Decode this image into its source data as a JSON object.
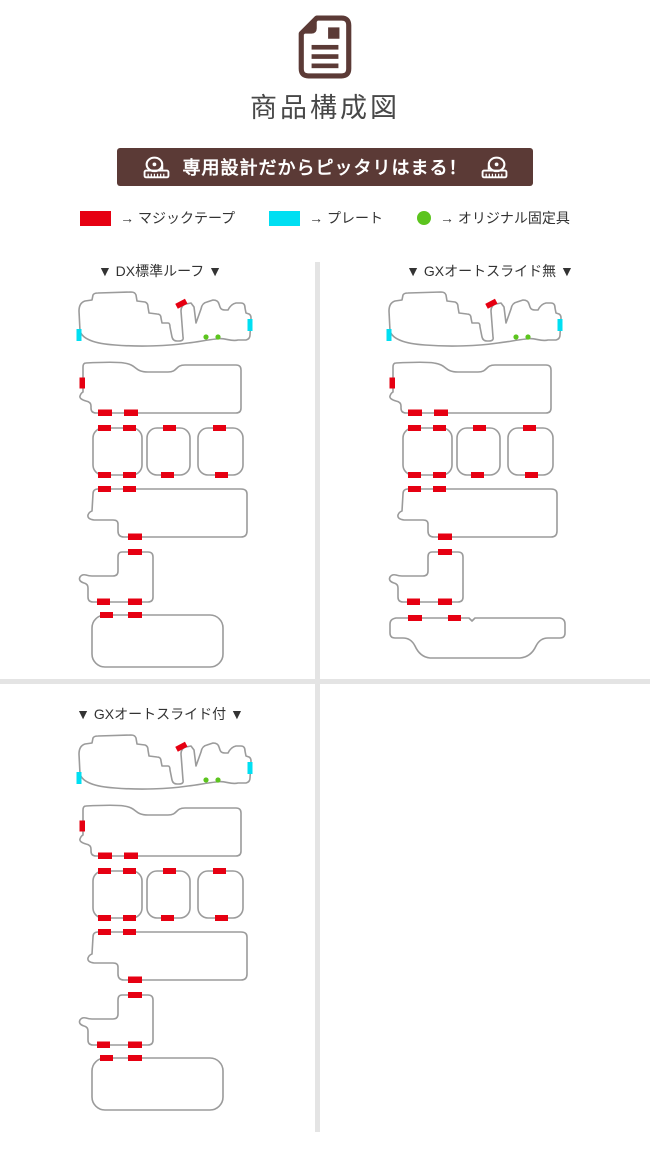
{
  "header": {
    "icon": "document-icon",
    "title": "商品構成図"
  },
  "banner": {
    "text": "専用設計だからピッタリはまる！",
    "bg_color": "#5b3a36",
    "text_color": "#ffffff",
    "left_icon": "measuring-tape-icon",
    "right_icon": "measuring-tape-icon"
  },
  "legend": {
    "items": [
      {
        "swatch_shape": "rectangle",
        "swatch_color": "#e60012",
        "label": "→ マジックテープ"
      },
      {
        "swatch_shape": "rectangle",
        "swatch_color": "#00dff2",
        "label": "→ プレート"
      },
      {
        "swatch_shape": "circle",
        "swatch_color": "#5cc41e",
        "label": "→ オリジナル固定具"
      }
    ]
  },
  "sections": [
    {
      "title": "▼ DX標準ルーフ ▼",
      "luggage_variant": "rounded-rect"
    },
    {
      "title": "▼ GXオートスライド無 ▼",
      "luggage_variant": "wheel-arch"
    },
    {
      "title": "▼ GXオートスライド付 ▼",
      "luggage_variant": "rounded-rect"
    }
  ],
  "diagram_colors": {
    "outline": "#9b9b9b",
    "velcro": "#e60012",
    "plate": "#00dff2",
    "fixture": "#5cc41e",
    "divider": "#e4e4e4"
  }
}
